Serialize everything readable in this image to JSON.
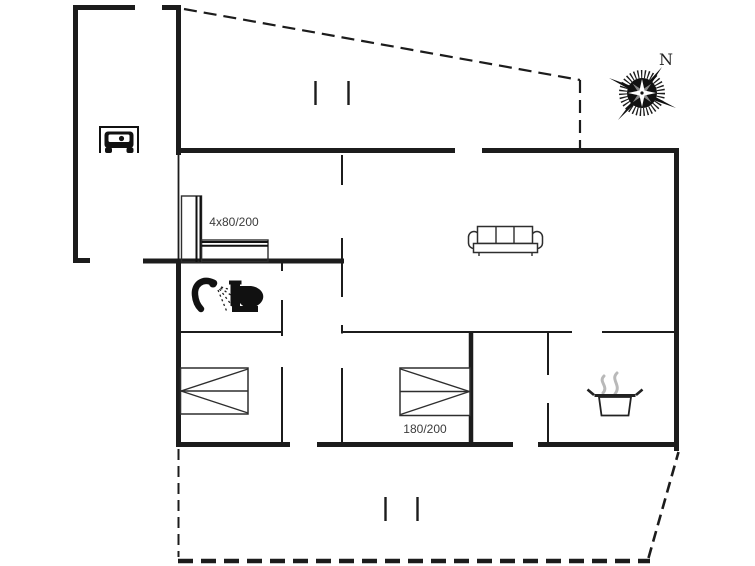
{
  "floor_plan": {
    "labels": {
      "wardrobe_size": "4x80/200",
      "bed_size": "180/200",
      "compass_north": "N"
    },
    "colors": {
      "wall": "#1c1c1c",
      "text": "#3c3c3c",
      "steam": "#b9b9b9",
      "background": "#ffffff"
    },
    "icons": [
      {
        "name": "car-icon"
      },
      {
        "name": "wardrobe-icon"
      },
      {
        "name": "shower-icon"
      },
      {
        "name": "toilet-icon"
      },
      {
        "name": "sofa-icon"
      },
      {
        "name": "double-bed-icon"
      },
      {
        "name": "double-bed-icon"
      },
      {
        "name": "cooking-pot-icon"
      },
      {
        "name": "compass-rose-icon"
      }
    ]
  }
}
